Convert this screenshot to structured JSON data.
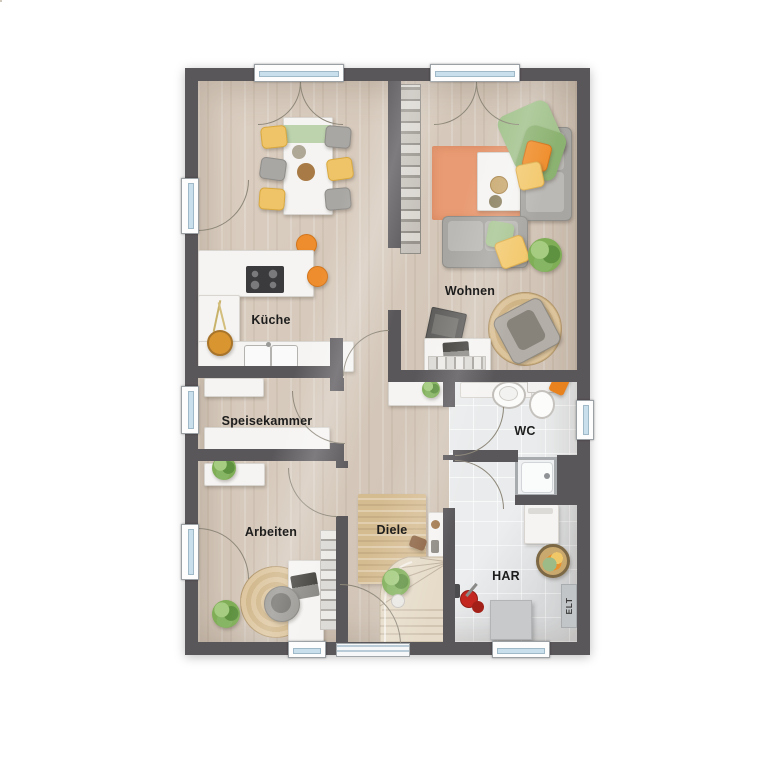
{
  "floor_plan": {
    "labels": {
      "kueche": "Küche",
      "wohnen": "Wohnen",
      "speisekammer": "Speisekammer",
      "arbeiten": "Arbeiten",
      "diele": "Diele",
      "wc": "WC",
      "har": "HAR",
      "elt": "ELT"
    },
    "colors": {
      "background": "#ffffff",
      "wall": "#5a575a",
      "wood_floor": "#d8cabb",
      "tile_floor_wc": "#e9ebec",
      "tile_floor_har": "#e2e4e6",
      "rug_living": "#e99b73",
      "rug_jute": "#d5bb90",
      "accent_orange": "#ee8d2d",
      "accent_yellow": "#f3c96e",
      "accent_green": "#8cb271",
      "furniture_white": "#f5f4f2",
      "furniture_gray": "#a8a6a2",
      "window_glass": "#cadfec"
    },
    "furniture": {
      "kueche": [
        "dining-table",
        "dining-chairs",
        "kitchen-counter",
        "cooktop",
        "sink",
        "bar-stools",
        "fruit-basket"
      ],
      "wohnen": [
        "bookshelf",
        "sofa",
        "couch",
        "coffee-table",
        "area-rug",
        "throw-blanket",
        "pillows",
        "tv-sideboard",
        "tv",
        "lounge-chair",
        "round-rug",
        "plant"
      ],
      "speisekammer": [
        "storage-shelves"
      ],
      "arbeiten": [
        "sideboard",
        "desk",
        "laptop",
        "office-chair",
        "round-rug",
        "wall-shelf",
        "plants"
      ],
      "diele": [
        "runner-rug",
        "console-table",
        "staircase",
        "plant",
        "cabinet"
      ],
      "wc": [
        "vanity",
        "washbasin",
        "toilet",
        "shower",
        "towel"
      ],
      "har": [
        "washing-machine",
        "laundry-basket",
        "vacuum-cleaner",
        "storage-box",
        "electrical-panel"
      ]
    }
  }
}
